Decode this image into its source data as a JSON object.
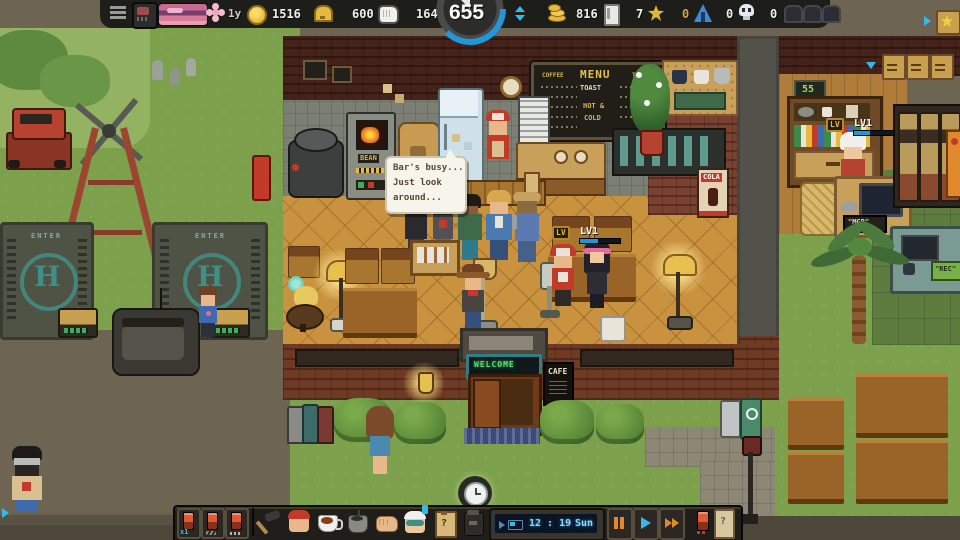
{
  "palette": {
    "accent_cyan": "#35b9e9",
    "accent_blue": "#2196d8",
    "gold": "#e7b93c",
    "orange_value": "#e0a43a",
    "led_green": "#52e06a",
    "hud_dark": "#1c1b19"
  },
  "top_hud": {
    "season": "1y",
    "stats_left": [
      {
        "id": "gold-coins",
        "value": "1516"
      },
      {
        "id": "bells",
        "value": "600"
      },
      {
        "id": "labor",
        "value": "164"
      }
    ],
    "day_counter": "655",
    "stats_right": [
      {
        "id": "cash",
        "value": "816"
      },
      {
        "id": "storage",
        "value": "7"
      },
      {
        "id": "stars",
        "value": "0"
      },
      {
        "id": "camps",
        "value": "0"
      },
      {
        "id": "skulls",
        "value": "0"
      }
    ]
  },
  "speech_bubble": {
    "lines": [
      "Bar's busy...",
      "Just look",
      "around..."
    ]
  },
  "menu_board": {
    "title": "MENU",
    "left_header": "COFFEE",
    "right_header": "TEA",
    "center_lines": [
      "TOAST",
      "HOT &",
      "COLD"
    ]
  },
  "signs": {
    "enter": "ENTER",
    "helipad_letter": "H",
    "bean_machine": "BEAN",
    "cola_poster": "COLA",
    "welcome": "WELCOME",
    "cafe": "CAFE",
    "office_number": "55",
    "manager_desk": "\"MGR\"",
    "workshop_desk": "\"REC\""
  },
  "badges": {
    "cafe_npc": {
      "tag": "LV",
      "label": "LV1"
    },
    "manager": {
      "tag": "LV",
      "label": "LV1"
    }
  },
  "bottom_hud": {
    "queue_count": "x1",
    "clipboard_glyph": "?",
    "mystery_card_glyph": "?",
    "time": "12 : 19",
    "day": "Sun"
  }
}
